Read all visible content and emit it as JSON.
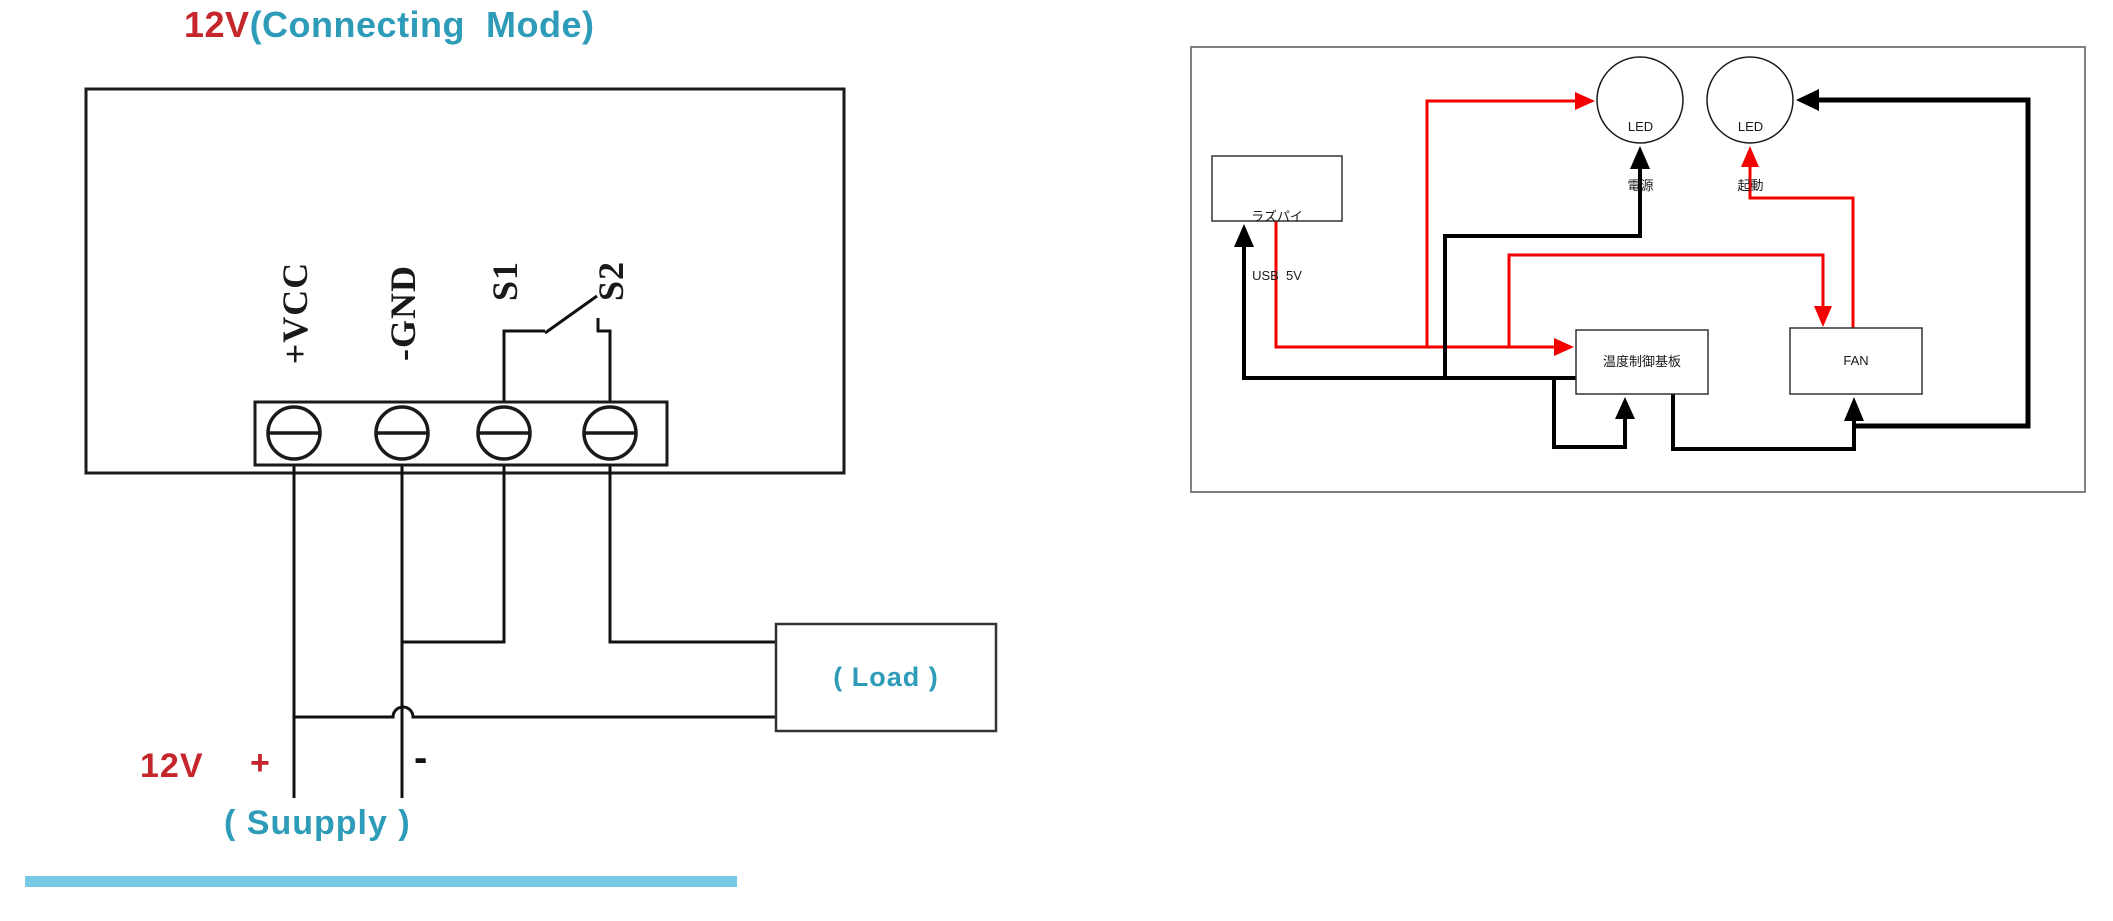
{
  "left_diagram": {
    "title": {
      "red": "12V",
      "teal": "(Connecting  Mode)"
    },
    "terminals": [
      "+VCC",
      "-GND",
      "S1",
      "S2"
    ],
    "load_label": "( Load )",
    "supply": {
      "voltage": "12V",
      "plus": "+",
      "minus": "-",
      "label": "( Suupply )"
    }
  },
  "right_diagram": {
    "nodes": {
      "led_power": {
        "line1": "LED",
        "line2": "電源"
      },
      "led_start": {
        "line1": "LED",
        "line2": "起動"
      },
      "raspi": {
        "line1": "ラズパイ",
        "line2": "USB  5V"
      },
      "temp_board": "温度制御基板",
      "fan": "FAN"
    }
  },
  "colors": {
    "red_text": "#c5262b",
    "teal_text": "#2e9cb8",
    "wire_red": "#f40000",
    "wire_black": "#000000",
    "bar_blue": "#76c9e4",
    "outer_box_gray": "#808080"
  }
}
